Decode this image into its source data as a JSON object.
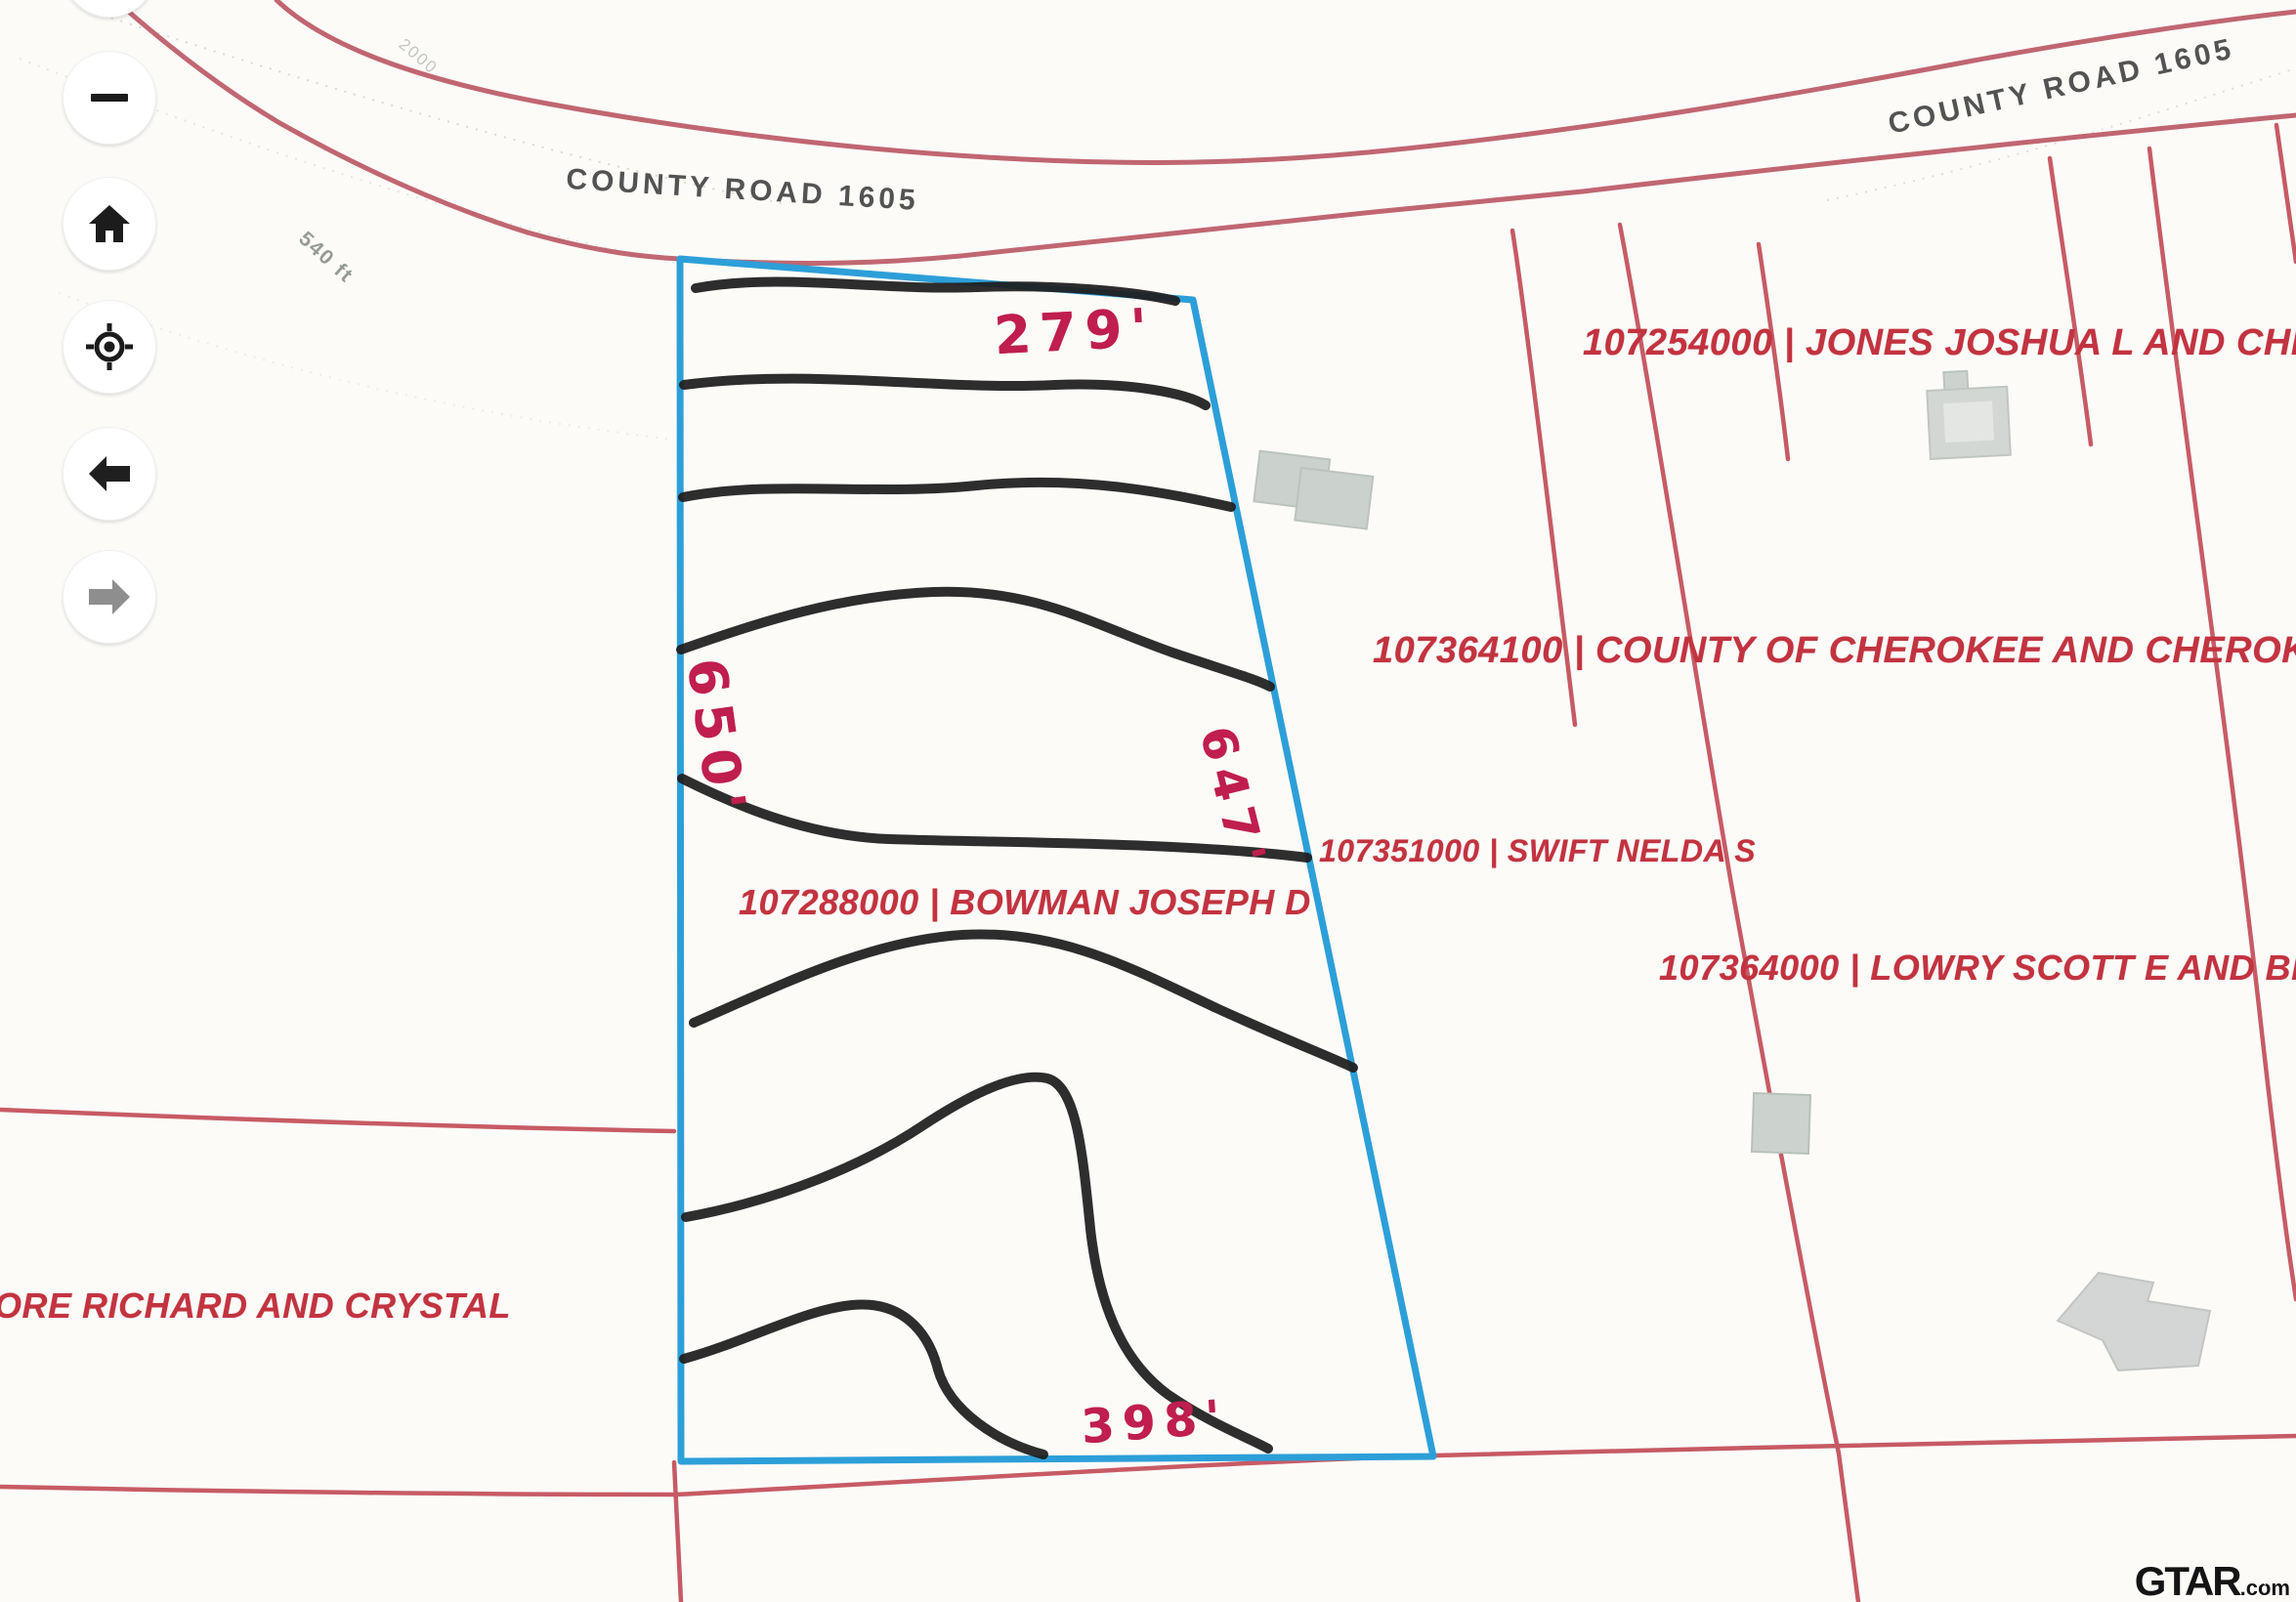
{
  "map_controls": {
    "zoom_in": {
      "icon": "plus-icon"
    },
    "zoom_out": {
      "icon": "minus-icon"
    },
    "home": {
      "icon": "home-icon"
    },
    "locate": {
      "icon": "crosshair-icon"
    },
    "back": {
      "icon": "arrow-left-icon"
    },
    "forward": {
      "icon": "arrow-right-icon"
    }
  },
  "road_labels": {
    "west": "COUNTY ROAD 1605",
    "east": "COUNTY ROAD 1605"
  },
  "map_annotations": {
    "scale_label": "540 ft",
    "contour_label": "2000"
  },
  "parcel_labels": {
    "jones": "107254000 | JONES JOSHUA L AND CHELSEA",
    "cherokee": "107364100 | COUNTY OF CHEROKEE AND CHEROKEE CEN",
    "swift": "107351000 | SWIFT NELDA S",
    "lowry": "107364000 | LOWRY SCOTT E AND BRI",
    "bowman": "107288000 | BOWMAN JOSEPH D",
    "moore": "ORE RICHARD AND CRYSTAL"
  },
  "subject_parcel": {
    "owner_label": "107288000 | BOWMAN JOSEPH D",
    "dimensions": {
      "top": "279'",
      "west": "650'",
      "east": "647'",
      "bottom": "398'"
    },
    "outline_color": "#2d9fd8"
  },
  "watermark": {
    "brand": "GTAR",
    "star": "★",
    "suffix": ".com"
  },
  "colors": {
    "road_line": "#bb5a66",
    "parcel_line": "#c14954",
    "label_red": "#c23340",
    "handwriting_red": "#bf1e4e",
    "highlight_blue": "#2d9fd8"
  }
}
